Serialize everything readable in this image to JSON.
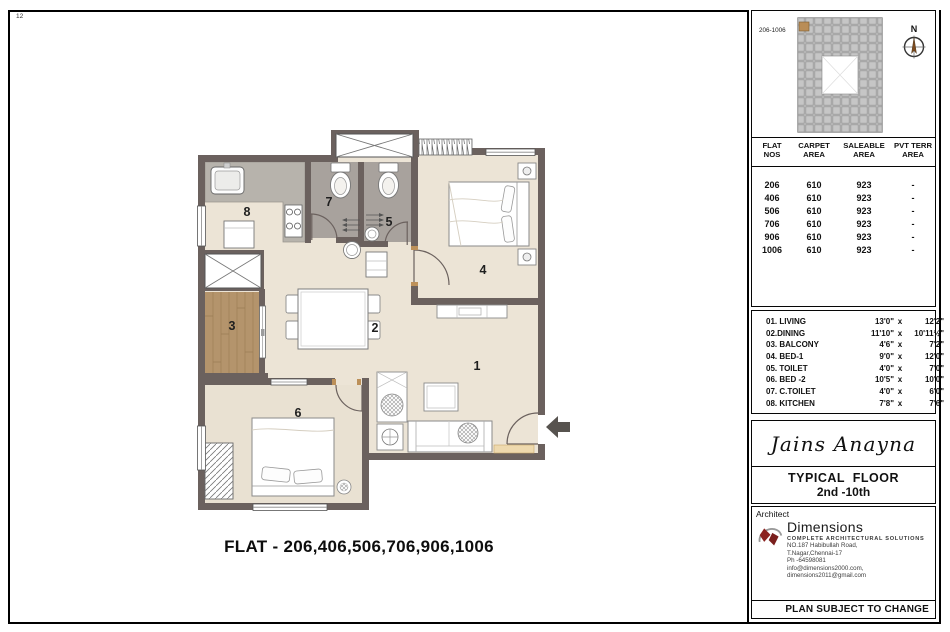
{
  "plan": {
    "sheet_note": "12",
    "caption": "FLAT - 206,406,506,706,906,1006",
    "room_labels": [
      "1",
      "2",
      "3",
      "4",
      "5",
      "6",
      "7",
      "8"
    ]
  },
  "keyplan": {
    "unit_label": "206-1006",
    "north_label": "N"
  },
  "areas": {
    "columns": [
      {
        "line1": "FLAT",
        "line2": "NOS"
      },
      {
        "line1": "CARPET",
        "line2": "AREA"
      },
      {
        "line1": "SALEABLE",
        "line2": "AREA"
      },
      {
        "line1": "PVT TERR",
        "line2": "AREA"
      }
    ],
    "rows": [
      {
        "flat": "206",
        "carpet": "610",
        "saleable": "923",
        "pvt": "-"
      },
      {
        "flat": "406",
        "carpet": "610",
        "saleable": "923",
        "pvt": "-"
      },
      {
        "flat": "506",
        "carpet": "610",
        "saleable": "923",
        "pvt": "-"
      },
      {
        "flat": "706",
        "carpet": "610",
        "saleable": "923",
        "pvt": "-"
      },
      {
        "flat": "906",
        "carpet": "610",
        "saleable": "923",
        "pvt": "-"
      },
      {
        "flat": "1006",
        "carpet": "610",
        "saleable": "923",
        "pvt": "-"
      }
    ]
  },
  "legend": {
    "dim_sep": "x",
    "items": [
      {
        "label": "01. LIVING",
        "dim_a": "13'0\"",
        "dim_b": "12'2\""
      },
      {
        "label": "02.DINING",
        "dim_a": "11'10\"",
        "dim_b": "10'11½\""
      },
      {
        "label": "03. BALCONY",
        "dim_a": "4'6\"",
        "dim_b": "7'2\""
      },
      {
        "label": "04. BED-1",
        "dim_a": "9'0\"",
        "dim_b": "12'0\""
      },
      {
        "label": "05. TOILET",
        "dim_a": "4'0\"",
        "dim_b": "7'0\""
      },
      {
        "label": "06. BED -2",
        "dim_a": "10'5\"",
        "dim_b": "10'0\""
      },
      {
        "label": "07. C.TOILET",
        "dim_a": "4'0\"",
        "dim_b": "6'0\""
      },
      {
        "label": "08. KITCHEN",
        "dim_a": "7'8\"",
        "dim_b": "7'6\""
      }
    ]
  },
  "project": {
    "name": "Jains Anayna",
    "floor_title": "TYPICAL  FLOOR",
    "floor_range": "2nd -10th"
  },
  "architect": {
    "section_label": "Architect",
    "firm": "Dimensions",
    "tagline": "COMPLETE ARCHITECTURAL SOLUTIONS",
    "address_line1": "NO.187 Habibullah Road,",
    "address_line2": "T.Nagar,Chennai-17",
    "address_line3": "Ph -64598081",
    "address_line4": "info@dimensions2000.com, dimensions2011@gmail.com"
  },
  "footer": {
    "note": "PLAN SUBJECT TO CHANGE"
  },
  "colors": {
    "wall": "#6b615e",
    "floor": "#ece4d6",
    "toilet_floor": "#a8a29d",
    "counter": "#b7b3ac",
    "balcony_wood": "#b4946c",
    "door_accent": "#bc9059",
    "entry_mat": "#eed9ae",
    "logo_red": "#8b2220"
  }
}
